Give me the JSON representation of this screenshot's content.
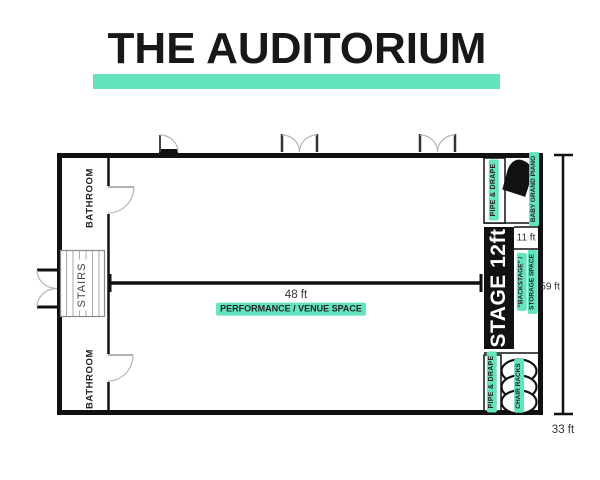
{
  "title": "THE AUDITORIUM",
  "colors": {
    "accent": "#63E4BF",
    "wall": "#111111",
    "ink": "#232323"
  },
  "plan": {
    "rooms": {
      "bathroom_top": "BATHROOM",
      "stairs": "STAIRS",
      "bathroom_bottom": "BATHROOM",
      "performance_space": "PERFORMANCE / VENUE SPACE",
      "stage": "STAGE 12ft",
      "backstage_line1": "\"BACKSTAGE\" /",
      "backstage_line2": "STORAGE SPACE"
    },
    "features": {
      "pipe_drape_top": "PIPE & DRAPE",
      "pipe_drape_bottom": "PIPE & DRAPE",
      "baby_grand_piano": "BABY GRAND PIANO",
      "chair_racks": "CHAIR RACKS"
    },
    "dimensions": {
      "venue_width": "48 ft",
      "backstage_depth": "11 ft",
      "overall_height": "59 ft",
      "overall_bottom": "33 ft"
    }
  }
}
